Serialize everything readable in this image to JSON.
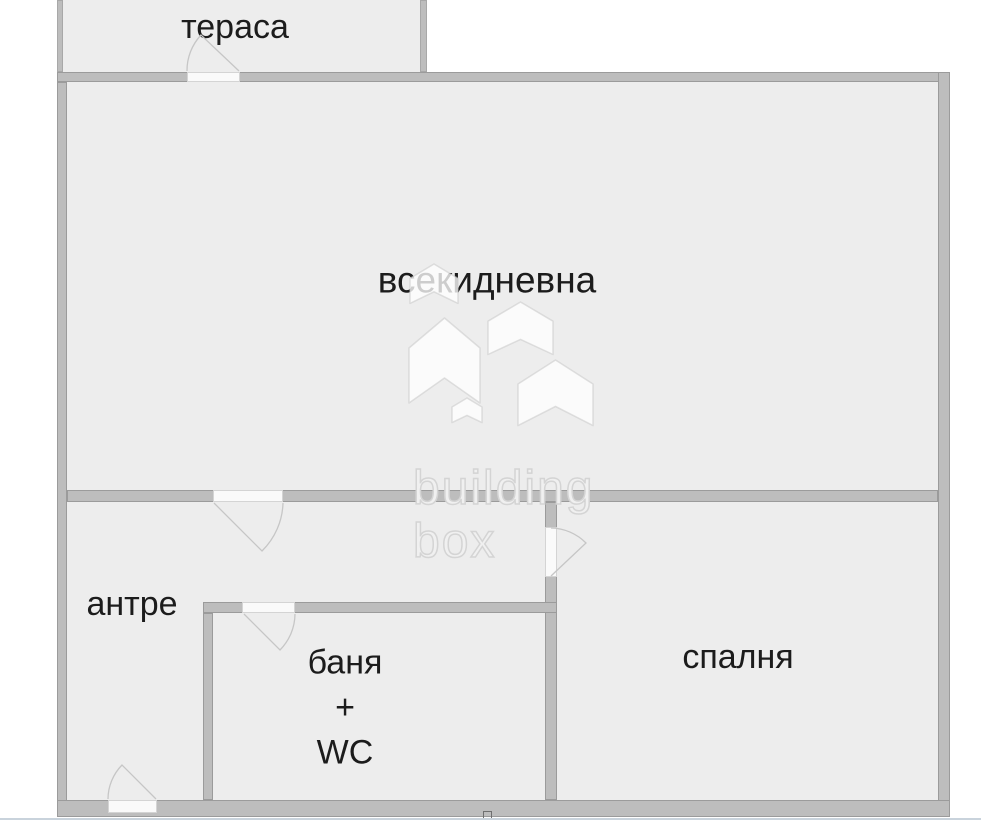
{
  "floor_plan": {
    "rooms": {
      "terrace": {
        "label": "тераса"
      },
      "living_room": {
        "label": "всекидневна"
      },
      "hallway": {
        "label": "антре"
      },
      "bathroom": {
        "line1": "баня",
        "line2": "+",
        "line3": "WC"
      },
      "bedroom": {
        "label": "спалня"
      }
    },
    "watermark": {
      "line1": "building",
      "line2": "box"
    },
    "colors": {
      "background": "#ffffff",
      "room_fill": "#ededed",
      "wall": "#bdbdbd",
      "wall_edge": "#9b9b9b",
      "door_opening": "#fafafa",
      "door_arc": "#c6c6c6",
      "label_text": "#1c1c1c",
      "watermark": "#d4d4d4",
      "bottom_strip": "#c9d3dc"
    }
  }
}
